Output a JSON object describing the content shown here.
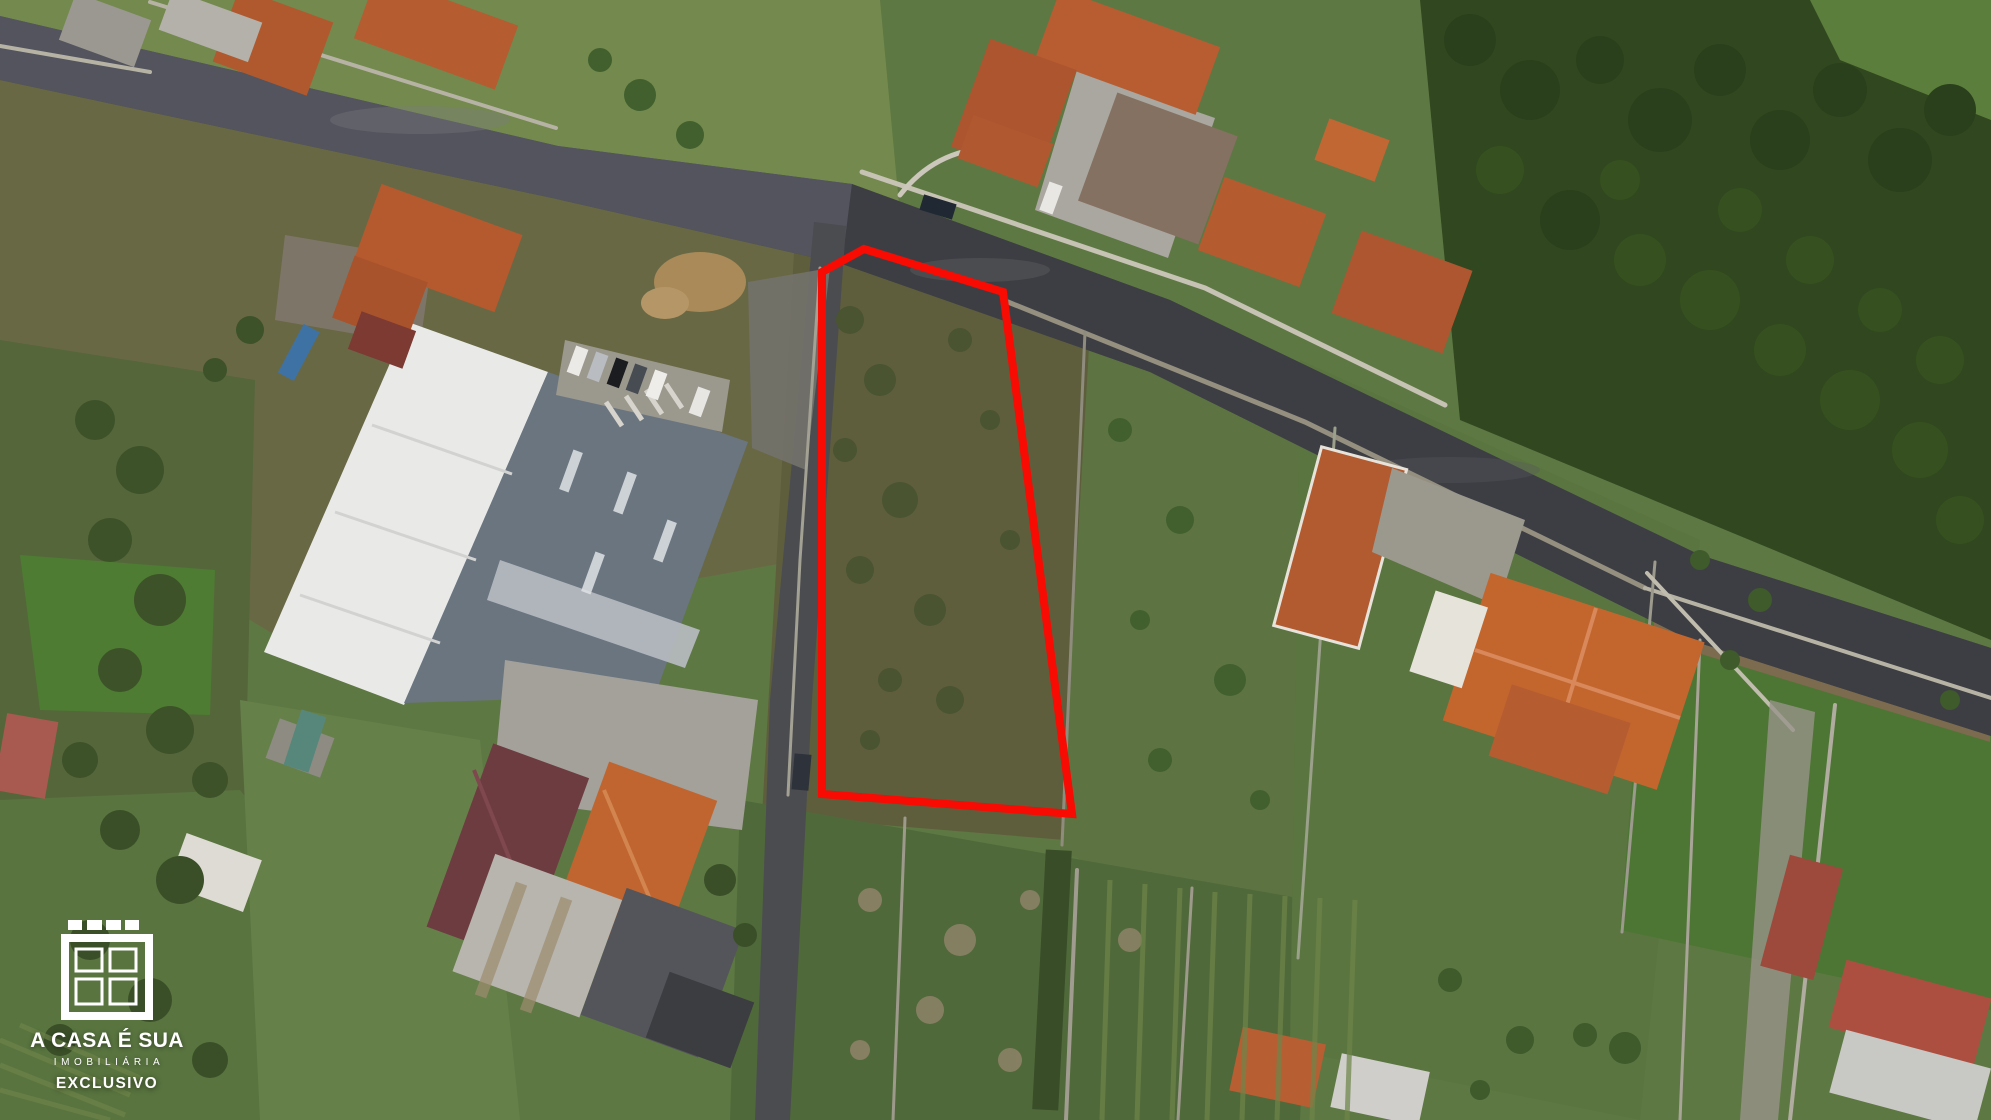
{
  "scene": {
    "description": "Aerial drone photograph of a Portuguese village block: asphalt roads, orange-tile roofed houses, a large white/grey warehouse, green fields and gardens, eucalyptus forest top-right. A vacant scrub plot is highlighted with a red outline. Real-estate watermark bottom-left.",
    "type": "aerial-drone-photo"
  },
  "plot": {
    "outline_points": "822,272 864,249 1003,292 1072,814 822,794",
    "outline_color": "#f70b02",
    "outline_width": "8"
  },
  "watermark": {
    "icon": "window-logo-icon",
    "brand": "A CASA É SUA",
    "tagline": "IMOBILIÁRIA",
    "badge": "EXCLUSIVO",
    "color": "#ffffff"
  },
  "palette": {
    "asphalt_new": "#3d3e43",
    "asphalt_old": "#565760",
    "roof_terracotta": "#b45a2f",
    "roof_bright_orange": "#c2662e",
    "roof_maroon": "#6d3c41",
    "roof_taupe": "#857162",
    "warehouse_white": "#e9eae8",
    "warehouse_grey": "#6a7580",
    "grass_green": "#5e7843",
    "scrub_olive": "#5e5e3d",
    "forest_dark": "#31471f",
    "wall_stone": "#b6b2a4",
    "plot_outline_red": "#f70b02"
  }
}
